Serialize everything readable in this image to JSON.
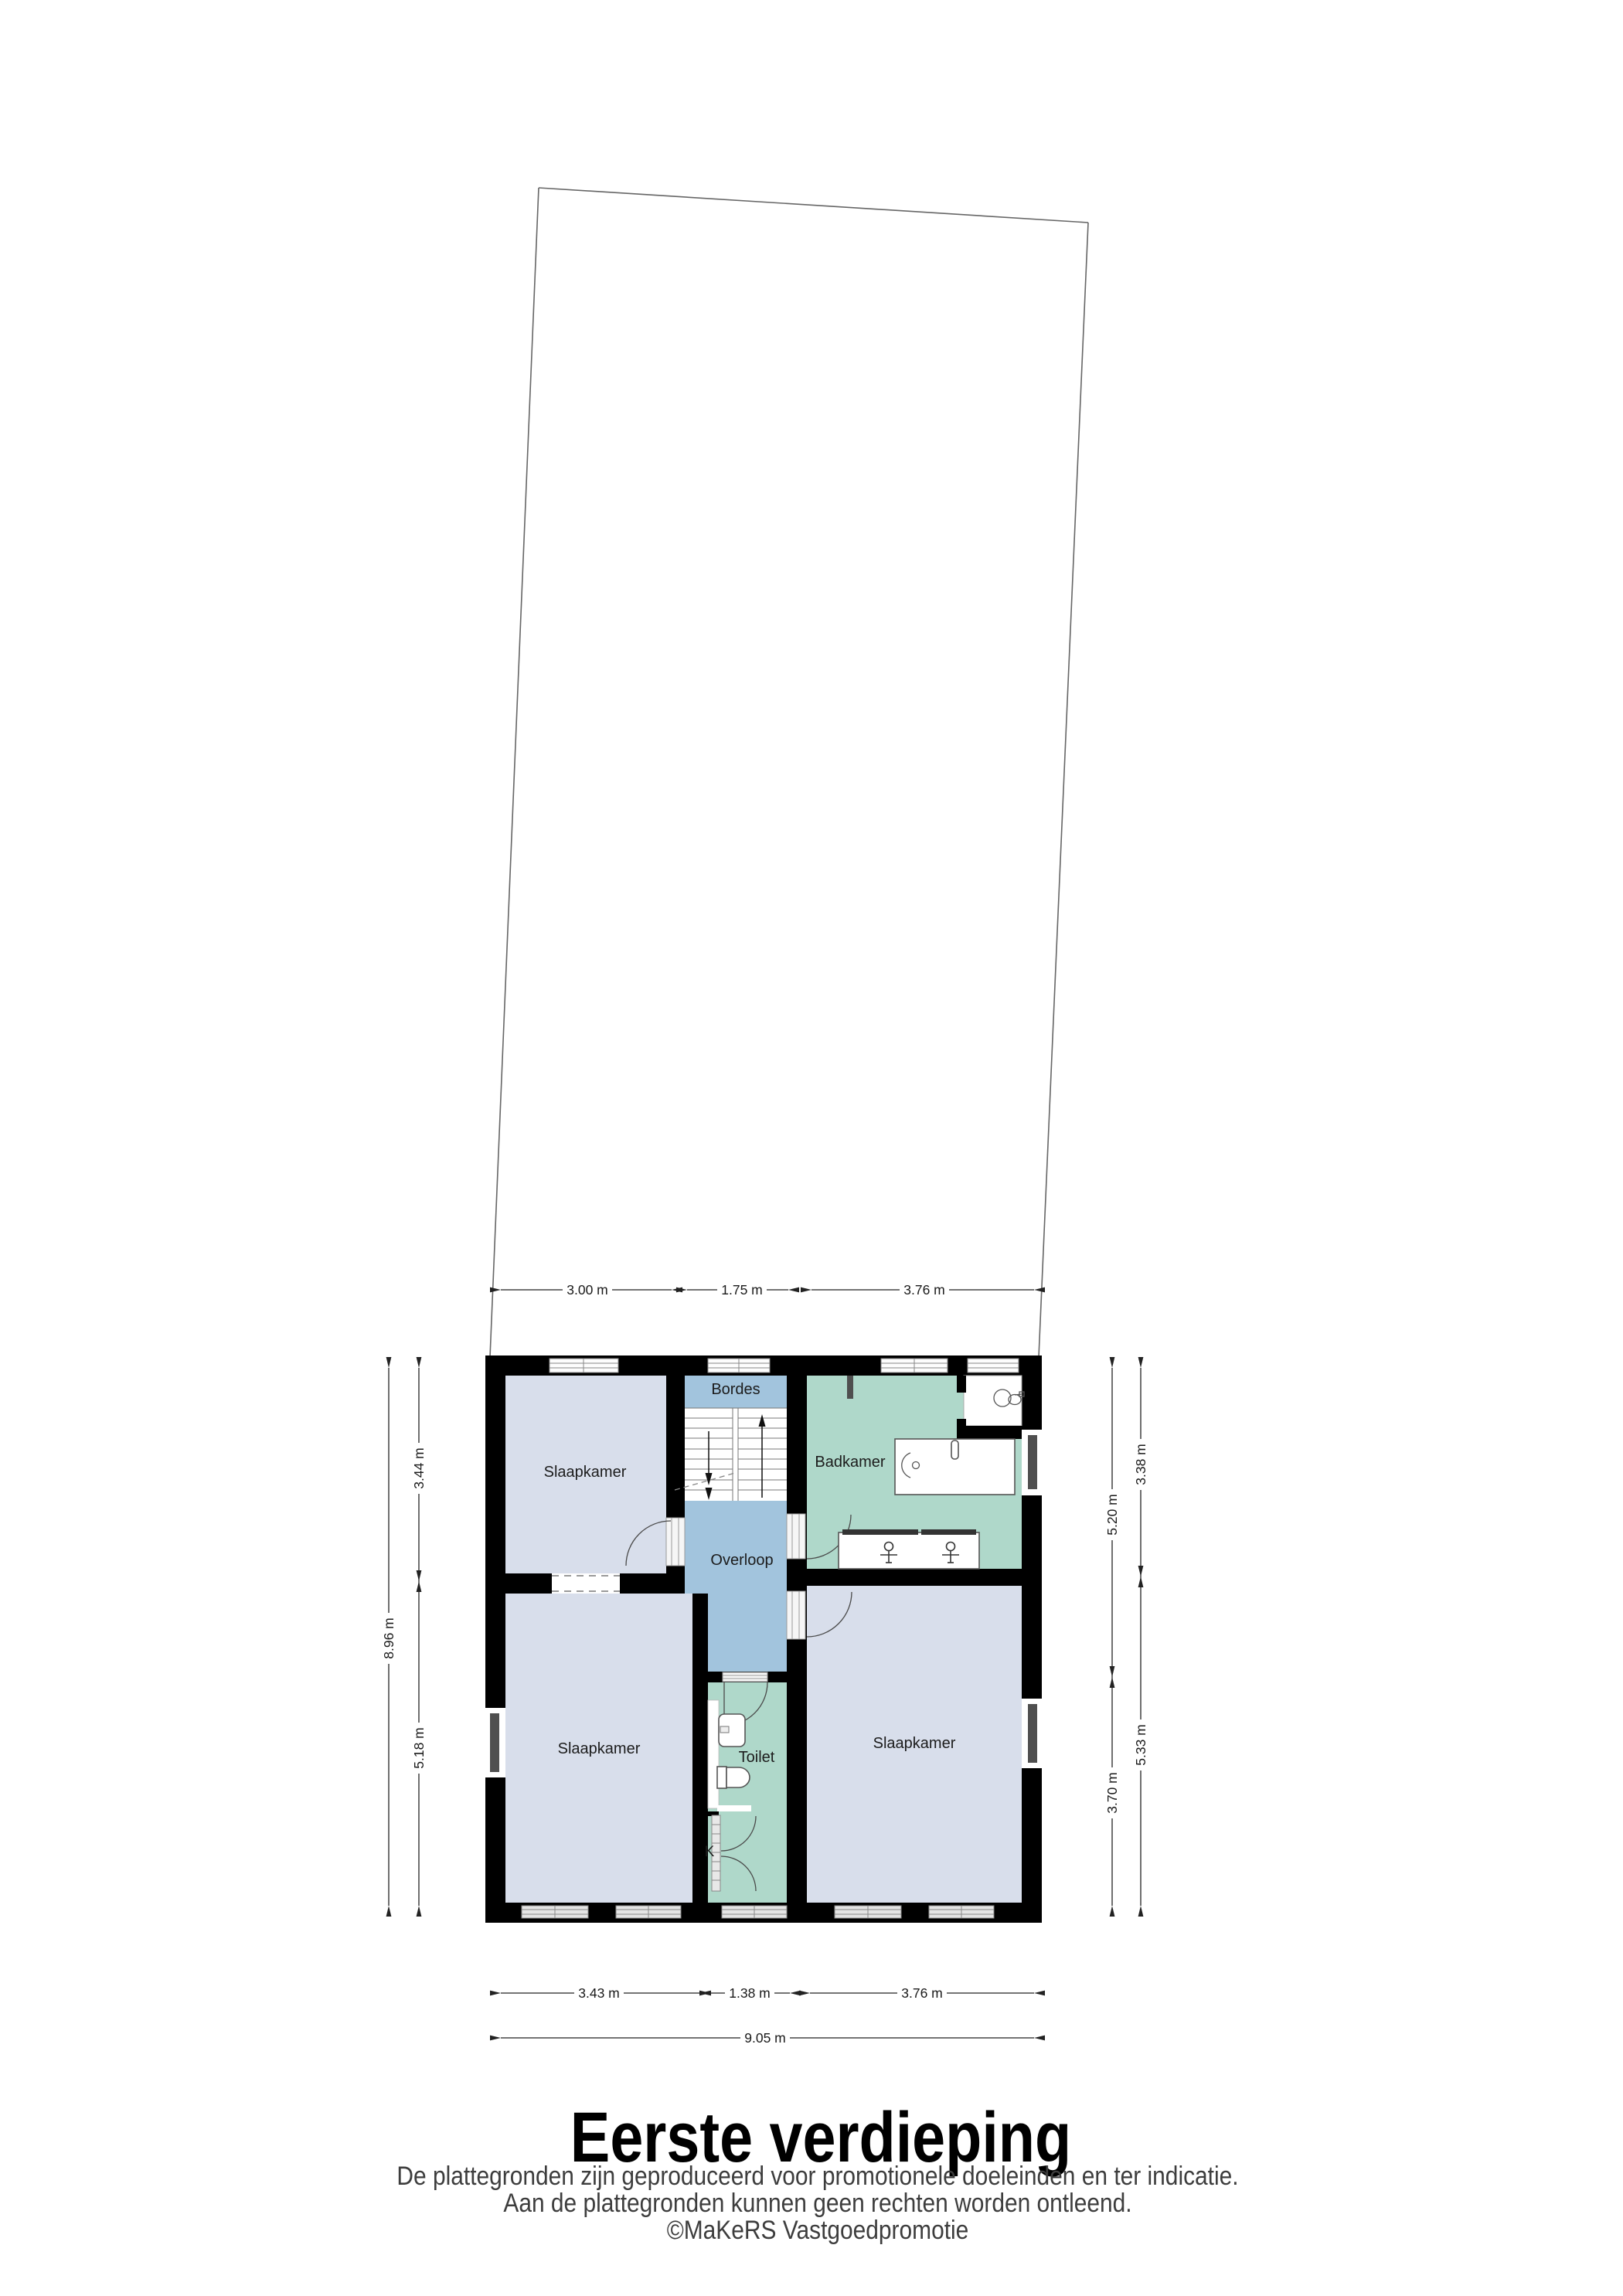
{
  "title": "Eerste verdieping",
  "disclaimer": {
    "line1": "De plattegronden zijn geproduceerd voor promotionele doeleinden en ter indicatie.",
    "line2": "Aan de plattegronden kunnen geen rechten worden ontleend.",
    "line3": "©MaKeRS Vastgoedpromotie"
  },
  "labels": {
    "bedroom_topleft": "Slaapkamer",
    "bedroom_bottomleft": "Slaapkamer",
    "bedroom_bottomright": "Slaapkamer",
    "bathroom": "Badkamer",
    "landing_top": "Bordes",
    "landing": "Overloop",
    "toilet": "Toilet",
    "closet": "K"
  },
  "dims": {
    "top_1": "3.00 m",
    "top_2": "1.75 m",
    "top_3": "3.76 m",
    "bottom_1": "3.43 m",
    "bottom_2": "1.38 m",
    "bottom_3": "3.76 m",
    "bottom_overall": "9.05 m",
    "left_outer": "8.96 m",
    "left_inner_top": "3.44 m",
    "left_inner_bottom": "5.18 m",
    "right_inner_top": "5.20 m",
    "right_inner_bottom": "3.70 m",
    "right_outer_top": "3.38 m",
    "right_outer_bottom": "5.33 m"
  },
  "colors": {
    "wall": "#000000",
    "bedroom": "#d8deeb",
    "bath": "#afd8ca",
    "hall": "#a2c4dd",
    "winframe": "#888888",
    "fixline": "#555555",
    "dimtext": "#1a1a1a",
    "disclaimer": "#3d3d3d",
    "niche": "#4f4f4f",
    "plotline": "#666666"
  }
}
